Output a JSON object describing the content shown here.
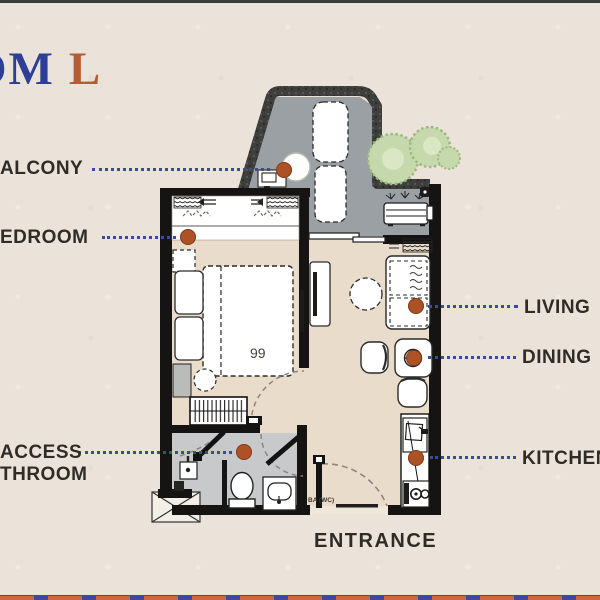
{
  "title": {
    "blue": "OM",
    "orange": "L"
  },
  "labels": {
    "balcony": "ALCONY",
    "bedroom": "EDROOM",
    "access_line1": "ACCESS",
    "access_line2": "THROOM",
    "living": "LIVING",
    "dining": "DINING",
    "kitchen": "KITCHEN",
    "entrance": "ENTRANCE",
    "bath_code": "BA (WC)",
    "bed_decor": "99"
  },
  "colors": {
    "paper": "#ebe3da",
    "wall": "#151413",
    "beige": "#e9dccb",
    "balc": "#9aa0a4",
    "bath": "#c7c9ca",
    "leader": "#3b4aa0",
    "marker": "#ad5227",
    "label": "#2f2c27",
    "tblue": "#2c3e96",
    "torange": "#b45c33",
    "treeA": "#c6d9ac",
    "treeB": "#dde8c8"
  }
}
